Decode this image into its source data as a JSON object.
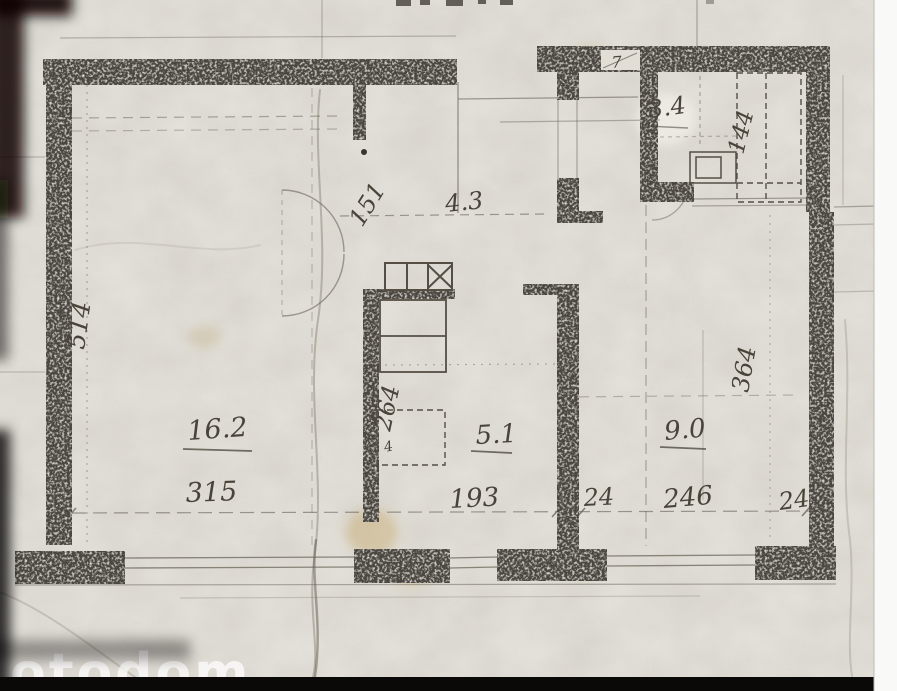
{
  "watermark": {
    "text": "otodom"
  },
  "plan": {
    "area_labels": {
      "room_main": "16.2",
      "kitchen": "5.1",
      "room_right": "9.0",
      "bathroom": "3.4",
      "hall": "4.3"
    },
    "dimension_labels": {
      "left_height": "514",
      "room_main_width": "315",
      "kitchen_width": "193",
      "kitchen_depth": "264",
      "hall_depth": "151",
      "room_right_width": "246",
      "room_right_depth": "364",
      "bathroom_width": "144",
      "wall_left": "24",
      "wall_right": "24",
      "door_mark": "7",
      "fixture_mark": "4"
    }
  }
}
